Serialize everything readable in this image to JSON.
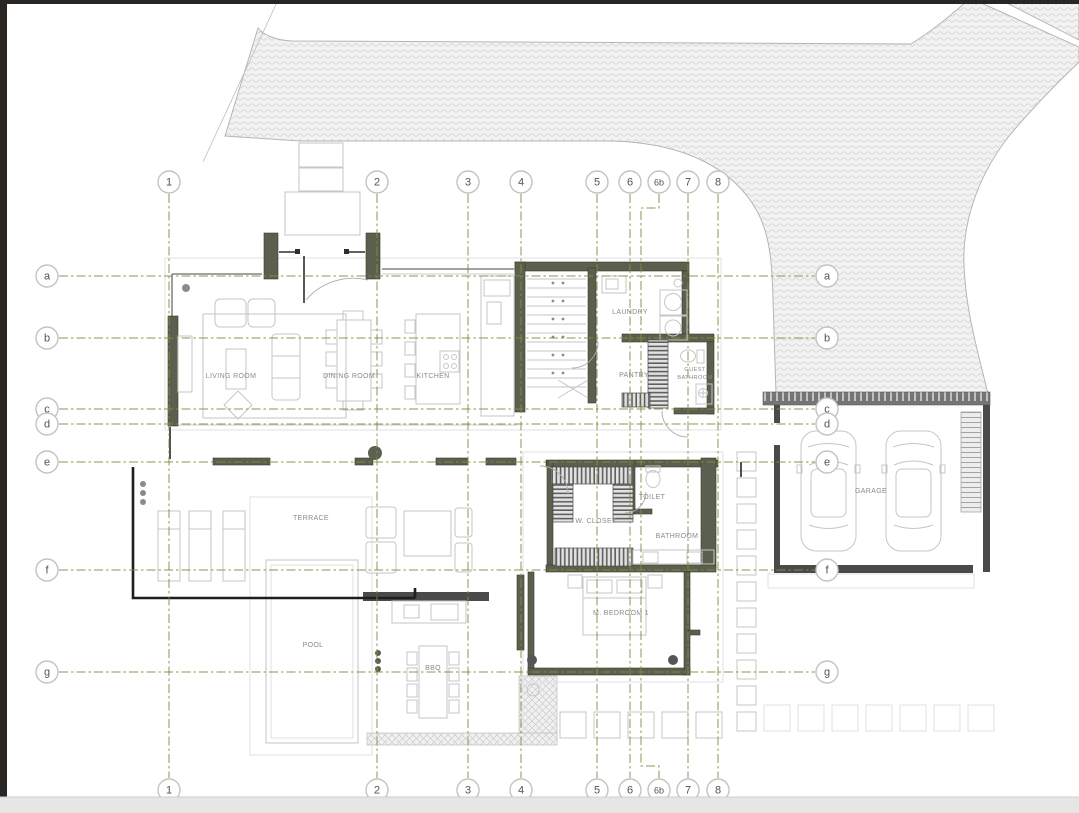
{
  "grid": {
    "columns": [
      {
        "label": "1"
      },
      {
        "label": "2"
      },
      {
        "label": "3"
      },
      {
        "label": "4"
      },
      {
        "label": "5"
      },
      {
        "label": "6"
      },
      {
        "label": "6b"
      },
      {
        "label": "7"
      },
      {
        "label": "8"
      }
    ],
    "rows": [
      {
        "label": "a"
      },
      {
        "label": "b"
      },
      {
        "label": "c"
      },
      {
        "label": "d"
      },
      {
        "label": "e"
      },
      {
        "label": "f"
      },
      {
        "label": "g"
      }
    ]
  },
  "rooms": {
    "living_room": {
      "label": "LIVING ROOM"
    },
    "dining_room": {
      "label": "DINING ROOM"
    },
    "kitchen": {
      "label": "KITCHEN"
    },
    "laundry": {
      "label": "LAUNDRY"
    },
    "pantry": {
      "label": "PANTRY"
    },
    "guest_bathroom": {
      "line1": "GUEST",
      "line2": "BATHROOM"
    },
    "terrace": {
      "label": "TERRACE"
    },
    "pool": {
      "label": "POOL"
    },
    "bbq": {
      "label": "BBQ"
    },
    "w_closet": {
      "label": "W. CLOSET"
    },
    "toilet": {
      "label": "TOILET"
    },
    "bathroom": {
      "label": "BATHROOM"
    },
    "m_bedroom_1": {
      "label": "M. BEDROOM 1"
    },
    "garage": {
      "label": "GARAGE"
    }
  },
  "colors": {
    "grid_line": "#7d8f40",
    "wall": "#5a604d",
    "boundary": "#1e1e1e",
    "furniture_line": "#c6c6c6",
    "road_hatch": "#cccccc",
    "label_text": "#8a8a8a",
    "page_edge": "#2a2624"
  }
}
